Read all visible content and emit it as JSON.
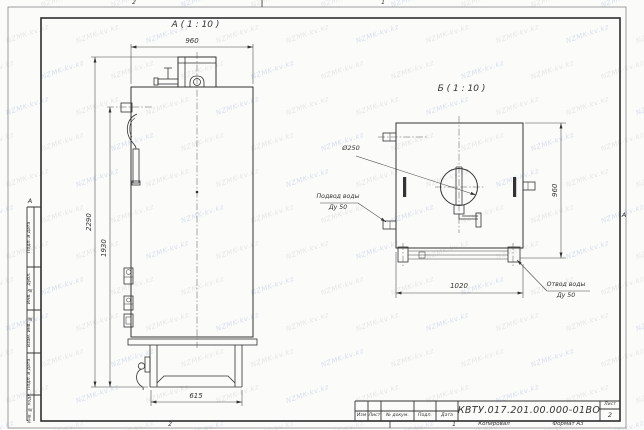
{
  "frame": {
    "zone_top": {
      "left_num": "2",
      "right_num": "1"
    },
    "zone_bottom": {
      "left_num": "2",
      "right_num": "1",
      "copied": "Копировал",
      "format": "Формат А3"
    },
    "zone_left_letter": "А",
    "zone_right_letter": "А",
    "sidebar_fields": [
      "Подп. и дата",
      "Инв. № дубл.",
      "Взам. инв. №",
      "Подп. и дата",
      "Инв. № подл."
    ]
  },
  "title_block": {
    "columns": [
      "Изм",
      "Лист",
      "№ докум.",
      "Подп.",
      "Дата"
    ],
    "designation": "КВТУ.017.201.00.000-01ВО",
    "sheet_label": "Лист",
    "sheet_number": "2"
  },
  "views": {
    "a": {
      "label": "А ( 1 : 10 )",
      "dims": {
        "width_top": "960",
        "height_total": "2290",
        "height_body": "1930",
        "base_width": "615"
      }
    },
    "b": {
      "label": "Б ( 1 : 10 )",
      "dims": {
        "width": "1020",
        "height": "960"
      },
      "callouts": {
        "flue_diameter": "Ø250",
        "inlet_line1": "Подвод воды",
        "inlet_line2": "Ду 50",
        "outlet_line1": "Отвод воды",
        "outlet_line2": "Ду 50"
      }
    }
  },
  "watermark": {
    "text": "NZMK-kv.kz",
    "color_blue": "#b8c6dd",
    "color_gray": "#d2d2d2"
  },
  "colors": {
    "line": "#333333",
    "paper": "#fbfbfa"
  }
}
